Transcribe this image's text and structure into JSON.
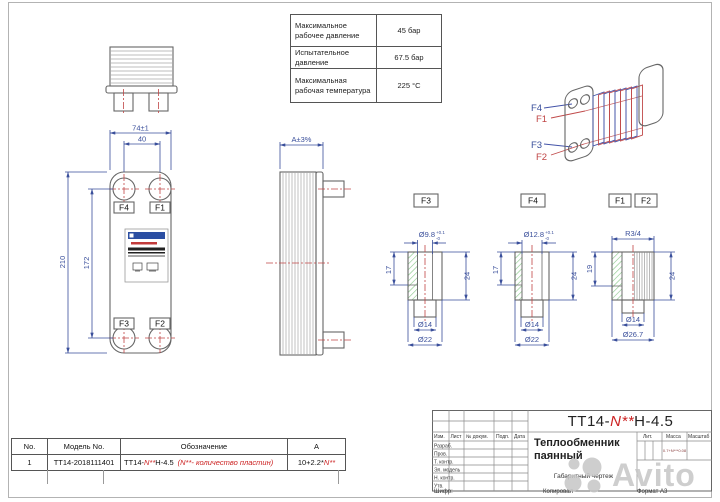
{
  "colors": {
    "dimension_blue": "#3a4f9b",
    "centerline_red": "#c04545",
    "accent_red": "#cc2222",
    "hatch_green": "#86c786",
    "brand_blue": "#2b4ea2",
    "watermark_gray": "#c6c6c6"
  },
  "watermark": {
    "text": "Avito"
  },
  "spec_table": {
    "rows": [
      {
        "label": "Максимальное рабочее давление",
        "value": "45 бар"
      },
      {
        "label": "Испытательное давление",
        "value": "67.5 бар"
      },
      {
        "label": "Максимальная рабочая температура",
        "value": "225 °C"
      }
    ]
  },
  "front_view": {
    "dim_width": "74±1",
    "dim_port_spacing": "40",
    "dim_height": "210",
    "dim_port_height": "172",
    "ports": {
      "tl": "F4",
      "tr": "F1",
      "bl": "F3",
      "br": "F2"
    }
  },
  "side_view": {
    "dim_thickness": "A±3%"
  },
  "iso_view": {
    "f4": "F4",
    "f1": "F1",
    "f3": "F3",
    "f2": "F2"
  },
  "fittings": {
    "f3": {
      "label": "F3",
      "bore_dia": "Ø9.8",
      "tol_upper": "+0.1",
      "tol_lower": "-0",
      "height_upper": "17",
      "height_total": "24",
      "stub_dia": "Ø14",
      "flange_dia": "Ø22"
    },
    "f4": {
      "label": "F4",
      "bore_dia": "Ø12.8",
      "tol_upper": "+0.1",
      "tol_lower": "-0",
      "height_upper": "17",
      "height_total": "24",
      "stub_dia": "Ø14",
      "flange_dia": "Ø22"
    },
    "f1f2": {
      "label_f1": "F1",
      "label_f2": "F2",
      "thread": "R3/4",
      "height_upper": "19",
      "height_total": "24",
      "stub_dia": "Ø14",
      "outer_dia": "Ø26.7"
    }
  },
  "parts_table": {
    "headers": {
      "no": "No.",
      "model": "Модель No.",
      "designation": "Обозначение",
      "a": "A"
    },
    "row": {
      "no": "1",
      "model": "TT14-2018111401",
      "des_p1": "ТТ14-",
      "des_p2": "N**",
      "des_p3": "H-4.5",
      "des_note": "(N**- количество пластин)",
      "a_p1": "10+2.2*",
      "a_p2": "N**"
    }
  },
  "title_block": {
    "title_p1": "ТТ14-",
    "title_p2": "N**",
    "title_p3": "H-4.5",
    "doc_name_line1": "Теплообменник",
    "doc_name_line2": "паянный",
    "doc_type": "Габаритный чертеж",
    "col_izm": "Изм.",
    "col_list": "Лист",
    "col_doc": "№ докум.",
    "col_podp": "Подп.",
    "col_data": "Дата",
    "rows": [
      "Разраб.",
      "Пров.",
      "Т. контр.",
      "Эл. модель",
      "Н. контр.",
      "Утв."
    ],
    "lit": "Лит.",
    "massa": "Масса",
    "masshtab": "Масштаб",
    "massa_value": "0.7+N***0.08",
    "shifr": "Шифр:",
    "kopiroval": "Копировал",
    "format": "Формат А3"
  }
}
